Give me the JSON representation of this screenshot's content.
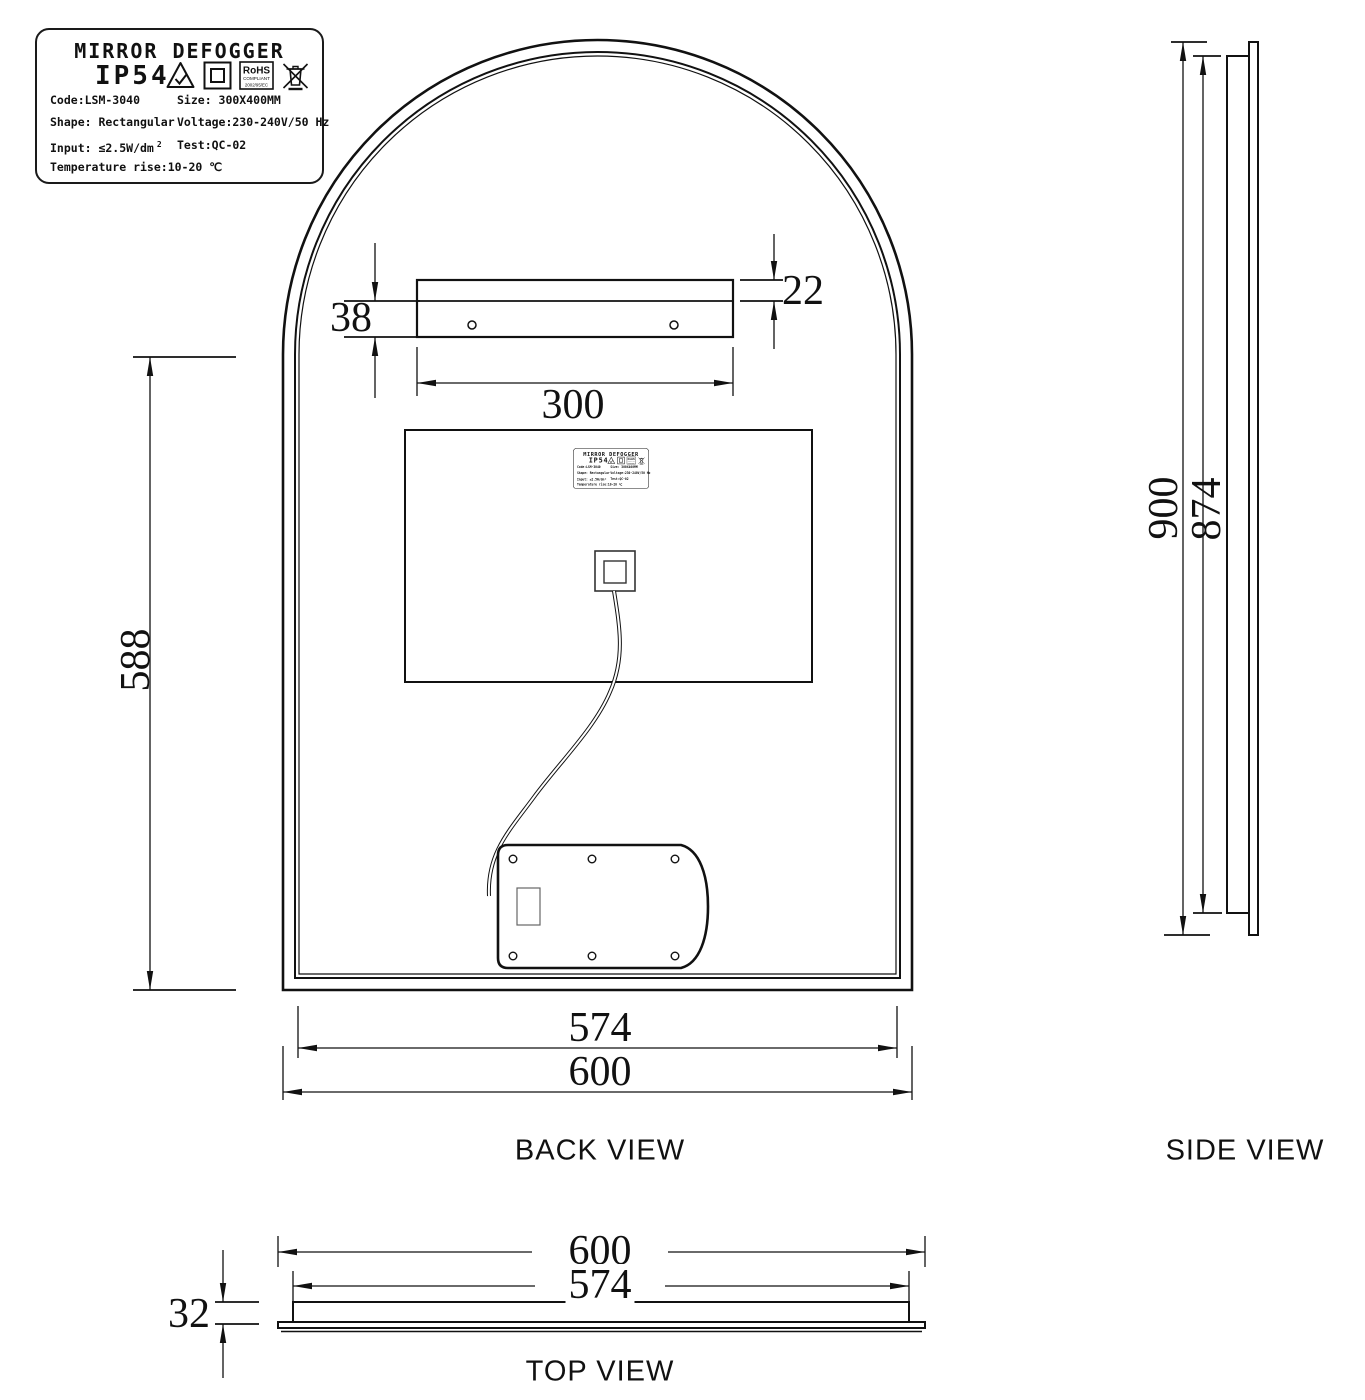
{
  "product_label": {
    "title": "MIRROR DEFOGGER",
    "ip_rating": "IP54",
    "code": "Code:LSM-3040",
    "size": "Size: 300X400MM",
    "shape": "Shape: Rectangular",
    "voltage": "Voltage:230-240V/50 Hz",
    "input": "Input: ≤2.5W/dm",
    "input_superscript": "2",
    "test": "Test:QC-02",
    "temperature": "Temperature rise:10-20 ℃",
    "rohs": {
      "line1": "RoHS",
      "line2": "COMPLIANT",
      "line3": "2002/95/EC"
    }
  },
  "views": {
    "back": "BACK VIEW",
    "side": "SIDE VIEW",
    "top": "TOP VIEW"
  },
  "dimensions_mm": {
    "bracket_upper_height": "22",
    "bracket_lower_height": "38",
    "bracket_width": "300",
    "straight_edge_height": "588",
    "inner_frame_width": "574",
    "overall_width": "600",
    "overall_height": "900",
    "frame_height": "874",
    "top_overall_width": "600",
    "top_inner_width": "574",
    "thickness": "32"
  }
}
